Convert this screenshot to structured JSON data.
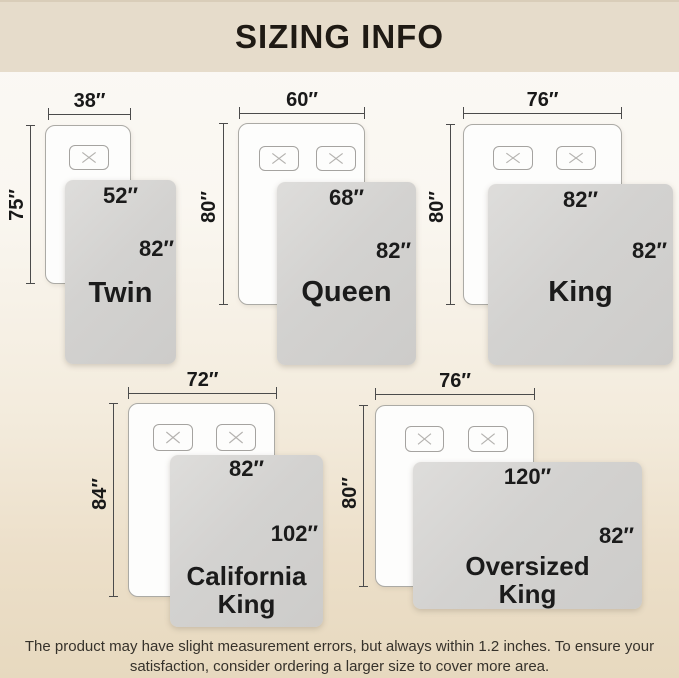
{
  "header": {
    "title": "SIZING INFO"
  },
  "sizes": [
    {
      "name": "Twin",
      "mattress_width": "38″",
      "mattress_length": "75″",
      "blanket_width": "52″",
      "blanket_length": "82″",
      "pillow_count": 1
    },
    {
      "name": "Queen",
      "mattress_width": "60″",
      "mattress_length": "80″",
      "blanket_width": "68″",
      "blanket_length": "82″",
      "pillow_count": 2
    },
    {
      "name": "King",
      "mattress_width": "76″",
      "mattress_length": "80″",
      "blanket_width": "82″",
      "blanket_length": "82″",
      "pillow_count": 2
    },
    {
      "name": "California King",
      "mattress_width": "72″",
      "mattress_length": "84″",
      "blanket_width": "82″",
      "blanket_length": "102″",
      "pillow_count": 2
    },
    {
      "name": "Oversized King",
      "mattress_width": "76″",
      "mattress_length": "80″",
      "blanket_width": "120″",
      "blanket_length": "82″",
      "pillow_count": 2
    }
  ],
  "footer": {
    "line1": "The product may have slight measurement errors, but always within 1.2 inches. To ensure your",
    "line2": "satisfaction, consider ordering a larger size to cover more area."
  },
  "colors": {
    "banner": "#e6dccb",
    "title_text": "#1f1a14",
    "blanket": "#d2d1cf",
    "dimension_line": "#4b4b4b",
    "label_text": "#191919",
    "background_top": "#fbf9f5",
    "background_bottom": "#e7d9bf"
  }
}
